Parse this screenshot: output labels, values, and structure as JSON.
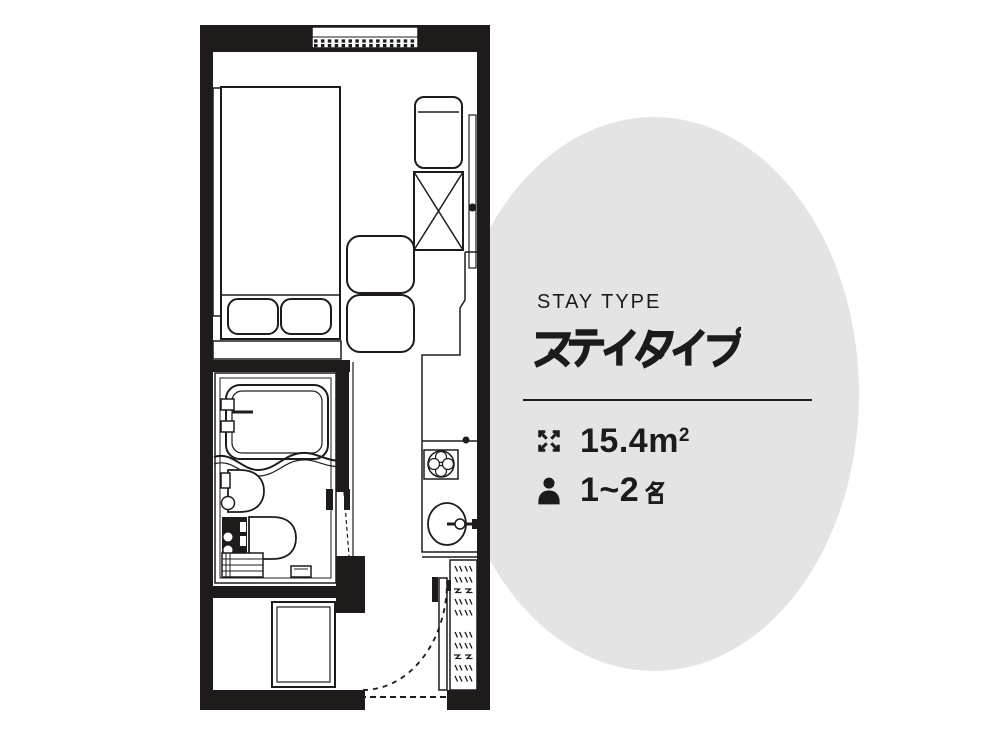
{
  "panel": {
    "label": "STAY TYPE",
    "title": "ステイタイプ",
    "area": {
      "value": "15.4",
      "unit": "m",
      "unit_exponent": "2"
    },
    "capacity": {
      "value": "1~2",
      "unit": "名"
    },
    "icons": {
      "area": "expand-arrows-icon",
      "capacity": "person-icon"
    }
  },
  "floor_plan": {
    "label": "ステイタイプ 15.4m2 1~2名 floor plan",
    "symbols": [
      "window",
      "double-bed",
      "pillows",
      "headboard",
      "bench-shelf",
      "armchair",
      "luggage-rack-x",
      "sliding-window",
      "floor-cushions",
      "kitchen-counter",
      "stove-burner",
      "kitchen-sink",
      "bathroom-unit",
      "bathtub",
      "bath-faucet",
      "washbasin",
      "toilet",
      "bath-step",
      "bath-mat",
      "bathroom-door",
      "entry-door",
      "door-swing-arc",
      "shoe-cabinet",
      "doormat"
    ]
  },
  "colors": {
    "background": "#ffffff",
    "ellipse": "#e5e4e4",
    "ink": "#1f1b1b",
    "text": "#1b1b1b"
  }
}
